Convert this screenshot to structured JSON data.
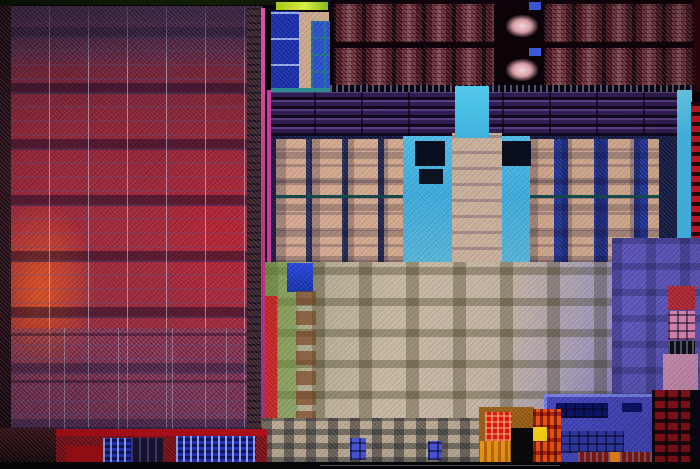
{
  "meta": {
    "subject": "processor-die-photograph",
    "description": "Silicon die shot of an APU: red GPU shader array on the left, dark-red media/cache block rows on top right, purple striped band, two tan CPU core clusters around a cyan cache column, tan-green uncore fabric at bottom center, violet I/O region at right, multicolor PHY blocks along the bottom edge. No text is visible in the image.",
    "width": 700,
    "height": 469
  },
  "palette": {
    "die_background": "#07060a",
    "gpu_red": "#a92834",
    "gpu_orange_hotspot": "#f25818",
    "media_block_maroon": "#4a1522",
    "stripe_band_purple": "#221136",
    "cpu_core_tan": "#d2a78b",
    "cache_cyan": "#3aa9d9",
    "uncore_tan": "#c7b79f",
    "uncore_green": "#6c9430",
    "io_violet": "#5a52b5",
    "phy_blue": "#2433bb",
    "fuse_orange": "#f09a12",
    "fuse_yellow": "#ffd818",
    "fuse_red": "#e01818",
    "edge_pink_line": "#d848a0",
    "lime_bar": "#c8de2e"
  },
  "regions": [
    {
      "name": "die-substrate",
      "x": 0,
      "y": 0,
      "w": 700,
      "h": 469,
      "bg": "#07060a",
      "tex": []
    },
    {
      "name": "gpu-shader-array",
      "x": 10,
      "y": 6,
      "w": 253,
      "h": 424,
      "bg": "radial-gradient(ellipse 80px 130px at 30px 285px, rgba(242,88,24,.9), rgba(242,88,24,0) 70%), radial-gradient(ellipse 120px 160px at 85% 55%, rgba(210,30,40,.5), rgba(210,30,40,0) 75%), linear-gradient(180deg,#472334 0%,#6f2231 12%,#962330 30%,#a92834 55%,#9e2a37 75%,#842634 100%)",
      "tex": [
        "tx-noise-b",
        "tx-rows-band",
        "tx-cols-lt",
        "tx-rows-thin"
      ]
    },
    {
      "name": "gpu-top-shade",
      "x": 10,
      "y": 6,
      "w": 253,
      "h": 56,
      "bg": "linear-gradient(180deg, rgba(52,32,58,.75), rgba(52,32,58,.12))",
      "tex": [
        "tx-noise-b"
      ]
    },
    {
      "name": "gpu-bottom-logic",
      "x": 10,
      "y": 328,
      "w": 253,
      "h": 102,
      "bg": "linear-gradient(180deg, rgba(96,62,110,.18), rgba(90,70,120,.34))",
      "tex": [
        "tx-grid-lg",
        "tx-noise-b"
      ]
    },
    {
      "name": "gpu-right-column-strip",
      "x": 247,
      "y": 8,
      "w": 15,
      "h": 422,
      "bg": "#38222a",
      "tex": [
        "tx-rows-dk",
        "tx-noise"
      ]
    },
    {
      "name": "gpu-edge-pink-line",
      "x": 261,
      "y": 8,
      "w": 4,
      "h": 420,
      "bg": "linear-gradient(180deg,#e050a8,#c03888 50%,#a03070)",
      "tex": []
    },
    {
      "name": "die-left-edge",
      "x": 0,
      "y": 0,
      "w": 11,
      "h": 469,
      "bg": "linear-gradient(180deg,#1a0810,#2a1018 40%,#200a12 80%,#0a0406)",
      "tex": [
        "tx-noise"
      ]
    },
    {
      "name": "die-top-edge",
      "x": 0,
      "y": 0,
      "w": 700,
      "h": 5,
      "bg": "linear-gradient(90deg,#0a1408,#122006 30%,#0a0a0a 60%,#050508)",
      "tex": []
    },
    {
      "name": "display-block-blue-panel",
      "x": 271,
      "y": 11,
      "w": 28,
      "h": 79,
      "bg": "#1b2da8",
      "tex": [
        "tx-rows-lt",
        "tx-noise-b"
      ]
    },
    {
      "name": "lime-bar",
      "x": 276,
      "y": 2,
      "w": 52,
      "h": 8,
      "bg": "linear-gradient(90deg,#a8c818,#d8ee48 55%,#88b818)",
      "tex": []
    },
    {
      "name": "tan-l-column",
      "x": 299,
      "y": 12,
      "w": 12,
      "h": 78,
      "bg": "#c8a88a",
      "tex": [
        "tx-noise"
      ]
    },
    {
      "name": "tan-l-top-arm",
      "x": 299,
      "y": 12,
      "w": 30,
      "h": 9,
      "bg": "#c8a88a",
      "tex": [
        "tx-noise"
      ]
    },
    {
      "name": "blue-grid-panel",
      "x": 311,
      "y": 21,
      "w": 25,
      "h": 69,
      "bg": "#2a50cc",
      "tex": [
        "tx-cells",
        "tx-noise-b"
      ]
    },
    {
      "name": "teal-baseline",
      "x": 271,
      "y": 88,
      "w": 65,
      "h": 5,
      "bg": "#2c8e92",
      "tex": []
    },
    {
      "name": "media-band-base",
      "x": 330,
      "y": 0,
      "w": 366,
      "h": 92,
      "bg": "#0f040b",
      "tex": []
    },
    {
      "name": "media-band-row-1",
      "x": 334,
      "y": 4,
      "w": 360,
      "h": 38,
      "bg": "repeating-linear-gradient(90deg, rgba(16,4,10,.95) 0 2px, rgba(74,21,34,.9) 2px 8px, rgba(122,52,64,.85) 8px 13px, rgba(150,95,100,.8) 13px 17px, rgba(122,52,64,.85) 17px 22px, rgba(74,21,34,.9) 22px 28px, rgba(16,4,10,.95) 28px 30px)",
      "tex": [
        "tx-pinkspeckle",
        "tx-rows-fine"
      ]
    },
    {
      "name": "media-band-row-2",
      "x": 334,
      "y": 48,
      "w": 360,
      "h": 38,
      "bg": "repeating-linear-gradient(90deg, rgba(16,4,10,.95) 0 2px, rgba(74,21,34,.9) 2px 8px, rgba(122,52,64,.85) 8px 13px, rgba(150,95,100,.8) 13px 17px, rgba(122,52,64,.85) 17px 22px, rgba(74,21,34,.9) 22px 28px, rgba(16,4,10,.95) 28px 30px)",
      "tex": [
        "tx-pinkspeckle",
        "tx-rows-fine"
      ]
    },
    {
      "name": "media-band-dark-gap",
      "x": 494,
      "y": 2,
      "w": 50,
      "h": 86,
      "bg": "#0b0308",
      "tex": []
    },
    {
      "name": "media-band-blob-1",
      "x": 506,
      "y": 15,
      "w": 32,
      "h": 22,
      "bg": "radial-gradient(ellipse at center,#f0d8d8 0%,#d8a0a8 40%, rgba(60,15,25,0) 75%)",
      "tex": []
    },
    {
      "name": "media-band-blob-2",
      "x": 506,
      "y": 59,
      "w": 32,
      "h": 22,
      "bg": "radial-gradient(ellipse at center,#f0d8d8 0%,#d8a0a8 40%, rgba(60,15,25,0) 75%)",
      "tex": []
    },
    {
      "name": "media-band-blue-chip-1",
      "x": 529,
      "y": 2,
      "w": 12,
      "h": 8,
      "bg": "#3a5ad8",
      "tex": []
    },
    {
      "name": "media-band-blue-chip-2",
      "x": 529,
      "y": 48,
      "w": 12,
      "h": 8,
      "bg": "#3a5ad8",
      "tex": []
    },
    {
      "name": "media-band-right-edge",
      "x": 694,
      "y": 0,
      "w": 6,
      "h": 92,
      "bg": "#2d060b",
      "tex": []
    },
    {
      "name": "under-band-dash-strip",
      "x": 330,
      "y": 85,
      "w": 366,
      "h": 9,
      "bg": "#0a050a",
      "tex": [
        "tx-dashes"
      ]
    },
    {
      "name": "sram-stripe-band",
      "x": 267,
      "y": 92,
      "w": 418,
      "h": 46,
      "bg": "#221136",
      "tex": [
        "tx-purplerows",
        "tx-colsep-dk"
      ]
    },
    {
      "name": "magenta-edge-line",
      "x": 267,
      "y": 90,
      "w": 4,
      "h": 176,
      "bg": "#cc3aa0",
      "tex": []
    },
    {
      "name": "cpu-complex-base",
      "x": 271,
      "y": 136,
      "w": 414,
      "h": 130,
      "bg": "#151b3e",
      "tex": [
        "tx-noise-b"
      ]
    },
    {
      "name": "cpu-core-cluster-left",
      "x": 276,
      "y": 139,
      "w": 127,
      "h": 124,
      "bg": "repeating-linear-gradient(90deg,#d2a78b 0 30px,#252c55 30px 36px)",
      "tex": [
        "tx-noise",
        "tx-corerows",
        "tx-cells-faint"
      ]
    },
    {
      "name": "cpu-core-left-midline",
      "x": 276,
      "y": 195,
      "w": 127,
      "h": 3,
      "bg": "#14484a",
      "tex": []
    },
    {
      "name": "cpu-core-cluster-right",
      "x": 528,
      "y": 139,
      "w": 131,
      "h": 124,
      "bg": "repeating-linear-gradient(90deg,#cba286 0 26px,#1d2f8e 26px 40px)",
      "tex": [
        "tx-noise",
        "tx-corerows",
        "tx-cells-faint"
      ]
    },
    {
      "name": "cpu-core-right-midline",
      "x": 528,
      "y": 195,
      "w": 131,
      "h": 3,
      "bg": "#14484a",
      "tex": []
    },
    {
      "name": "l3-cache-cyan-region",
      "x": 403,
      "y": 136,
      "w": 127,
      "h": 130,
      "bg": "linear-gradient(180deg,#4cbce6 0%,#3aa9d9 45%,#55b4d6 100%)",
      "tex": [
        "tx-noise"
      ]
    },
    {
      "name": "l3-dark-macro-1",
      "x": 415,
      "y": 141,
      "w": 30,
      "h": 25,
      "bg": "#0a0f1f",
      "tex": []
    },
    {
      "name": "l3-dark-macro-2",
      "x": 501,
      "y": 141,
      "w": 30,
      "h": 25,
      "bg": "#0a0f1f",
      "tex": []
    },
    {
      "name": "l3-dark-macro-3",
      "x": 419,
      "y": 169,
      "w": 24,
      "h": 15,
      "bg": "#0c1322",
      "tex": []
    },
    {
      "name": "l3-tan-center-column",
      "x": 452,
      "y": 133,
      "w": 50,
      "h": 133,
      "bg": "#c8ae97",
      "tex": [
        "tx-noise",
        "tx-corerows"
      ]
    },
    {
      "name": "cyan-pillar",
      "x": 455,
      "y": 86,
      "w": 34,
      "h": 52,
      "bg": "linear-gradient(180deg,#52c8ea,#3fb2dc)",
      "tex": []
    },
    {
      "name": "right-cyan-strip",
      "x": 677,
      "y": 90,
      "w": 15,
      "h": 152,
      "bg": "linear-gradient(180deg,#66d2f0,#44b8e4 30%,#3fb0de)",
      "tex": []
    },
    {
      "name": "right-red-io-column",
      "x": 691,
      "y": 102,
      "w": 9,
      "h": 140,
      "bg": "repeating-linear-gradient(0deg,#c01824 0 6px,#2a0408 6px 10px)",
      "tex": []
    },
    {
      "name": "uncore-fabric",
      "x": 265,
      "y": 262,
      "w": 422,
      "h": 168,
      "bg": "linear-gradient(100deg,#8aa46e 0%,#b5ab90 14%,#c7b79f 32%,#c2b19f 55%,#a89dae 70%,#8f84c4 84%,#7f74c4 100%)",
      "tex": [
        "tx-noise",
        "tx-blocks"
      ]
    },
    {
      "name": "uncore-green-strip",
      "x": 265,
      "y": 262,
      "w": 33,
      "h": 162,
      "bg": "rgba(108,148,48,.5)",
      "tex": [
        "tx-noise"
      ]
    },
    {
      "name": "uncore-blue-block",
      "x": 287,
      "y": 263,
      "w": 26,
      "h": 29,
      "bg": "linear-gradient(180deg,#2a48e0,#1430a8)",
      "tex": [
        "tx-noise-b"
      ]
    },
    {
      "name": "uncore-red-strip",
      "x": 265,
      "y": 296,
      "w": 12,
      "h": 130,
      "bg": "#c32222",
      "tex": [
        "tx-noise"
      ]
    },
    {
      "name": "uncore-brown-macro-column",
      "x": 296,
      "y": 290,
      "w": 20,
      "h": 135,
      "bg": "repeating-linear-gradient(0deg, rgba(120,62,30,.65) 0 14px, transparent 14px 20px)",
      "tex": []
    },
    {
      "name": "bottom-tan-city",
      "x": 262,
      "y": 418,
      "w": 222,
      "h": 45,
      "bg": "#b9a88f",
      "tex": [
        "tx-city",
        "tx-noise"
      ]
    },
    {
      "name": "bottom-tan-blue-chip-1",
      "x": 350,
      "y": 438,
      "w": 16,
      "h": 22,
      "bg": "#4a55d8",
      "tex": [
        "tx-cells-dk"
      ]
    },
    {
      "name": "bottom-tan-blue-chip-2",
      "x": 428,
      "y": 441,
      "w": 14,
      "h": 19,
      "bg": "#4a55d8",
      "tex": [
        "tx-cells-dk"
      ]
    },
    {
      "name": "io-violet-region",
      "x": 612,
      "y": 238,
      "w": 88,
      "h": 162,
      "bg": "linear-gradient(180deg,#5a52b5,#6159c0 50%,#5b53b8)",
      "tex": [
        "tx-noise-b",
        "tx-cells-faint"
      ]
    },
    {
      "name": "io-red-macro",
      "x": 668,
      "y": 286,
      "w": 27,
      "h": 24,
      "bg": "#b42430",
      "tex": [
        "tx-noise"
      ]
    },
    {
      "name": "io-pink-macro",
      "x": 668,
      "y": 311,
      "w": 27,
      "h": 29,
      "bg": "#e088b8",
      "tex": [
        "tx-cells-dk"
      ]
    },
    {
      "name": "io-black-macro",
      "x": 668,
      "y": 341,
      "w": 27,
      "h": 13,
      "bg": "#101014",
      "tex": [
        "tx-dashes"
      ]
    },
    {
      "name": "io-pink-speckle-block",
      "x": 663,
      "y": 354,
      "w": 35,
      "h": 38,
      "bg": "#cf8fb4",
      "tex": [
        "tx-noise"
      ]
    },
    {
      "name": "display-phy-strip",
      "x": 55,
      "y": 429,
      "w": 212,
      "h": 34,
      "bg": "#7d0d14",
      "tex": [
        "tx-noise"
      ]
    },
    {
      "name": "display-phy-top-band",
      "x": 55,
      "y": 429,
      "w": 212,
      "h": 7,
      "bg": "#b01018",
      "tex": []
    },
    {
      "name": "display-phy-blue-panel-1",
      "x": 103,
      "y": 438,
      "w": 28,
      "h": 25,
      "bg": "#2433bb",
      "tex": [
        "tx-dotrows"
      ]
    },
    {
      "name": "display-phy-dark-panel",
      "x": 131,
      "y": 438,
      "w": 32,
      "h": 25,
      "bg": "#1a1430",
      "tex": [
        "tx-cols-sm"
      ]
    },
    {
      "name": "display-phy-blue-panel-2",
      "x": 176,
      "y": 436,
      "w": 80,
      "h": 26,
      "bg": "#2433bb",
      "tex": [
        "tx-dotrows"
      ]
    },
    {
      "name": "display-phy-red-block",
      "x": 66,
      "y": 446,
      "w": 36,
      "h": 16,
      "bg": "#a61016",
      "tex": []
    },
    {
      "name": "bottom-left-corner",
      "x": 0,
      "y": 428,
      "w": 56,
      "h": 41,
      "bg": "linear-gradient(180deg,#3a1216,#200a0c 60%,#0a0506)",
      "tex": [
        "tx-noise"
      ]
    },
    {
      "name": "ddr-phy-blue-region",
      "x": 544,
      "y": 394,
      "w": 114,
      "h": 69,
      "bg": "linear-gradient(180deg,#7a85f0 0,#7a85f0 3px,rgba(0,0,0,0) 3px), linear-gradient(90deg,#7a85f0 0,#7a85f0 3px,rgba(0,0,0,0) 3px), linear-gradient(0deg,#434cc8,#4a44c0)",
      "tex": [
        "tx-noise-b"
      ]
    },
    {
      "name": "ddr-phy-dark-bar-1",
      "x": 556,
      "y": 403,
      "w": 52,
      "h": 15,
      "bg": "#0c1468",
      "tex": [
        "tx-cells-dk"
      ]
    },
    {
      "name": "ddr-phy-dark-bar-2",
      "x": 622,
      "y": 403,
      "w": 20,
      "h": 9,
      "bg": "#0c1468",
      "tex": []
    },
    {
      "name": "ddr-phy-cell-rows",
      "x": 560,
      "y": 431,
      "w": 64,
      "h": 22,
      "bg": "#333cae",
      "tex": [
        "tx-cells-dk"
      ]
    },
    {
      "name": "ddr-phy-red-bar",
      "x": 578,
      "y": 452,
      "w": 76,
      "h": 10,
      "bg": "#8c1a10",
      "tex": [
        "tx-dashes"
      ]
    },
    {
      "name": "ddr-phy-orange-dot",
      "x": 610,
      "y": 452,
      "w": 10,
      "h": 10,
      "bg": "#ff8c1a",
      "tex": []
    },
    {
      "name": "fuse-block-frame",
      "x": 479,
      "y": 407,
      "w": 55,
      "h": 57,
      "bg": "#9a5c10",
      "tex": [
        "tx-noise"
      ]
    },
    {
      "name": "fuse-red-macro",
      "x": 485,
      "y": 412,
      "w": 27,
      "h": 29,
      "bg": "#e01818",
      "tex": [
        "tx-cross"
      ]
    },
    {
      "name": "fuse-orange-columns",
      "x": 480,
      "y": 441,
      "w": 30,
      "h": 22,
      "bg": "repeating-linear-gradient(90deg,#f09a12 0 4px,#c06a08 4px 7px)",
      "tex": []
    },
    {
      "name": "fuse-black-macro",
      "x": 511,
      "y": 428,
      "w": 22,
      "h": 36,
      "bg": "#0a0a0c",
      "tex": []
    },
    {
      "name": "fuse-right-cell-grid",
      "x": 533,
      "y": 409,
      "w": 28,
      "h": 55,
      "bg": "repeating-linear-gradient(0deg,#f85510 0 9px,#b82408 9px 13px)",
      "tex": [
        "tx-dots-dk"
      ]
    },
    {
      "name": "fuse-yellow-cell",
      "x": 533,
      "y": 427,
      "w": 14,
      "h": 14,
      "bg": "#ffd818",
      "tex": []
    },
    {
      "name": "bottom-right-red-rows",
      "x": 652,
      "y": 390,
      "w": 39,
      "h": 73,
      "bg": "repeating-linear-gradient(0deg,#8c1218 0 7px,#230810 7px 11px)",
      "tex": [
        "tx-colgap"
      ]
    },
    {
      "name": "bottom-right-corner",
      "x": 690,
      "y": 390,
      "w": 10,
      "h": 79,
      "bg": "#0b0712",
      "tex": []
    },
    {
      "name": "die-bottom-edge",
      "x": 0,
      "y": 462,
      "w": 700,
      "h": 7,
      "bg": "#050609",
      "tex": []
    },
    {
      "name": "bottom-scribe-line",
      "x": 320,
      "y": 465,
      "w": 240,
      "h": 1,
      "bg": "rgba(160,160,170,.5)",
      "tex": []
    },
    {
      "name": "photo-vignette",
      "x": 0,
      "y": 0,
      "w": 700,
      "h": 469,
      "bg": "radial-gradient(ellipse at 50% 45%, rgba(0,0,0,0) 60%, rgba(0,0,0,.22) 100%)",
      "tex": []
    }
  ]
}
